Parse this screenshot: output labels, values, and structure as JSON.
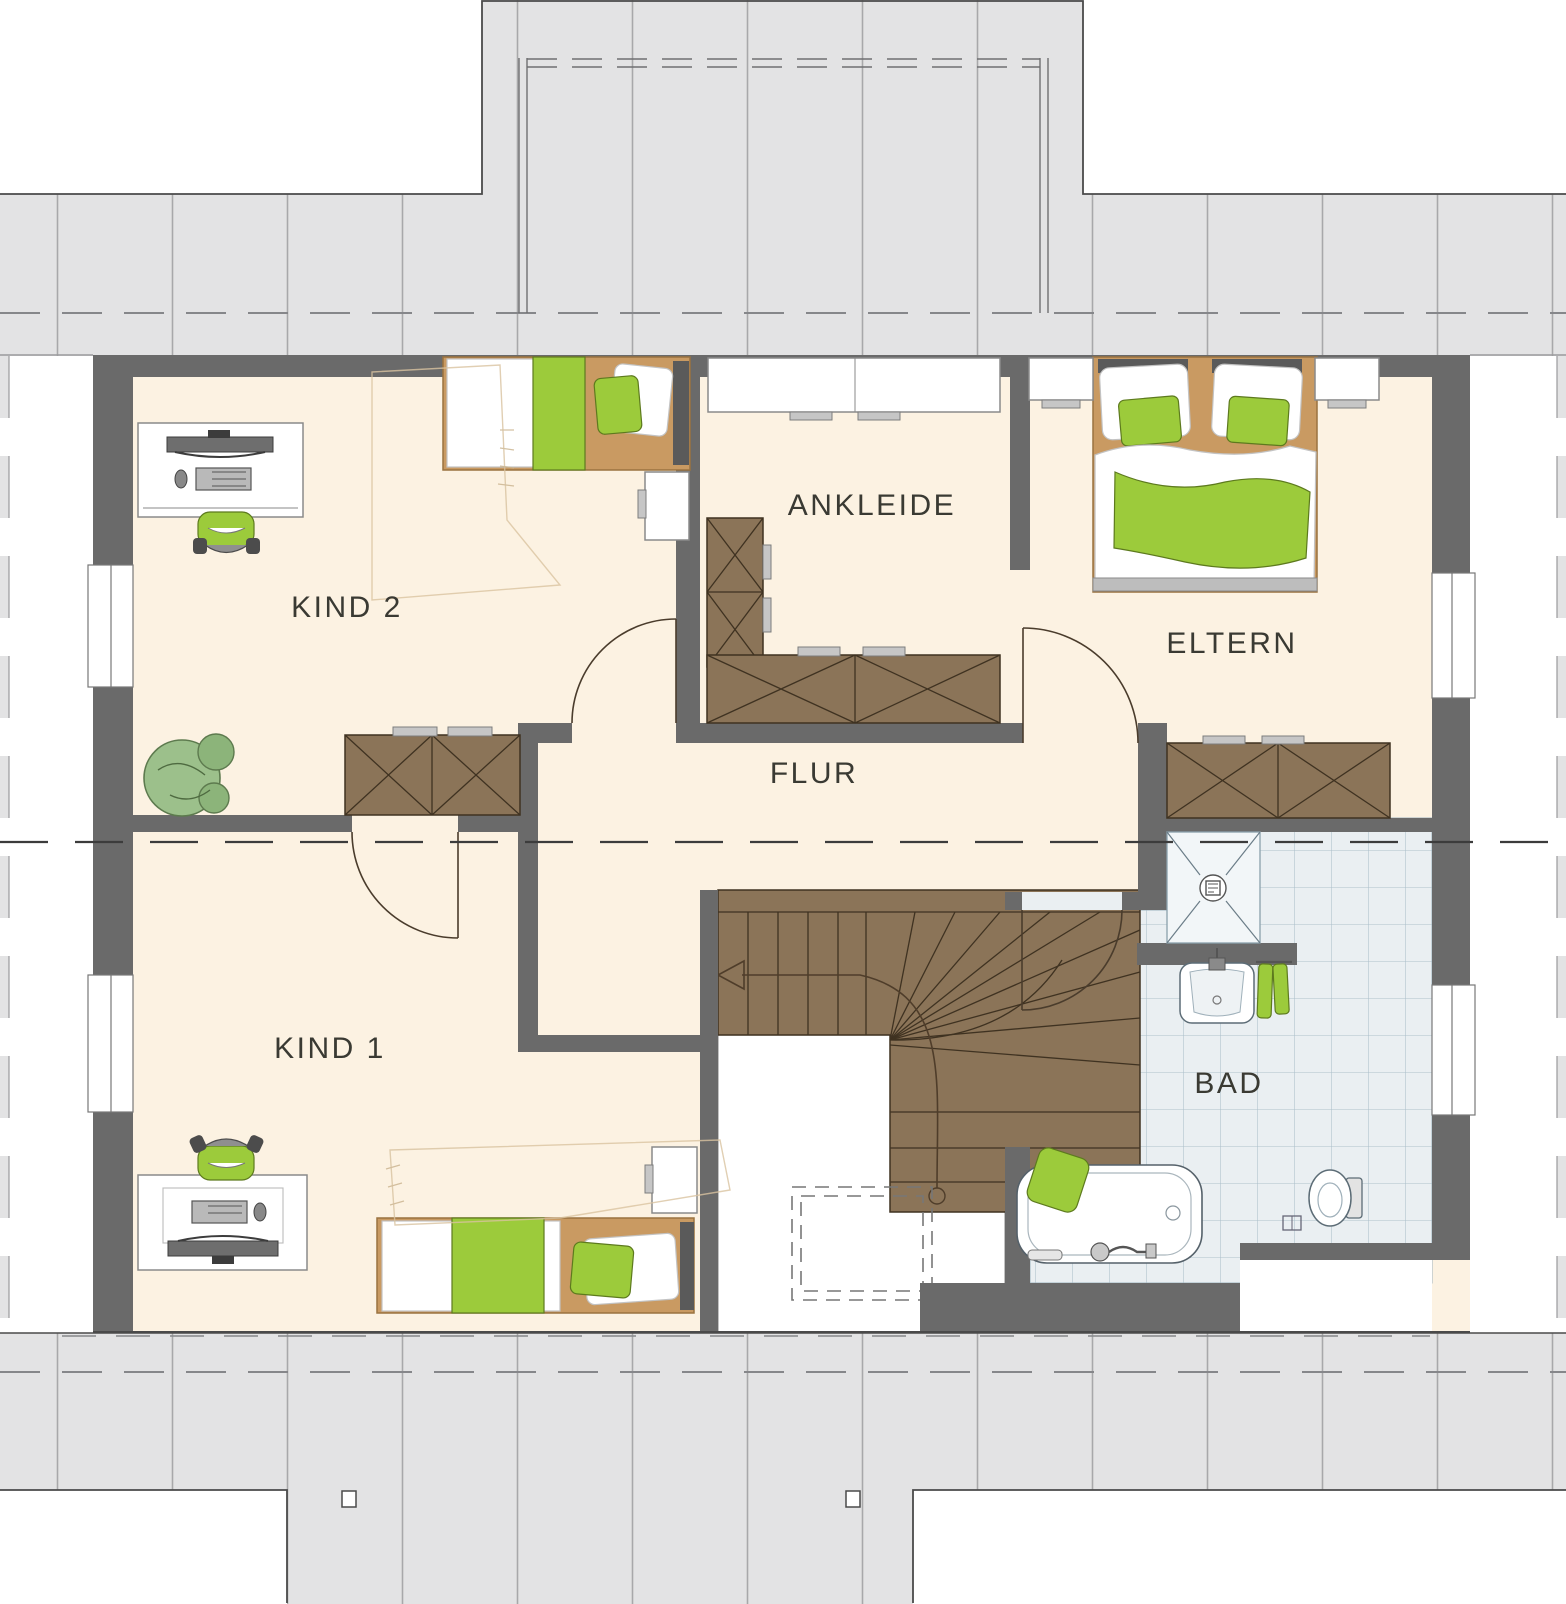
{
  "plan_title": "Dachgeschoss Grundriss",
  "rooms": {
    "kind2": {
      "label": "KIND 2"
    },
    "ankleide": {
      "label": "ANKLEIDE"
    },
    "eltern": {
      "label": "ELTERN"
    },
    "flur": {
      "label": "FLUR"
    },
    "kind1": {
      "label": "KIND 1"
    },
    "bad": {
      "label": "BAD"
    }
  },
  "colors": {
    "floor": "#fcf2e2",
    "roof": "#e3e3e4",
    "roof_seam": "#a8a8aa",
    "wall": "#6a6a6a",
    "wood_furniture": "#8b7458",
    "wood_outline": "#3f3221",
    "bed_frame": "#c99a62",
    "accent_green": "#9ccb3b",
    "bath_tile": "#eaeff2",
    "bath_tile_line": "#adc0cb",
    "label_text": "#3a3a33"
  }
}
